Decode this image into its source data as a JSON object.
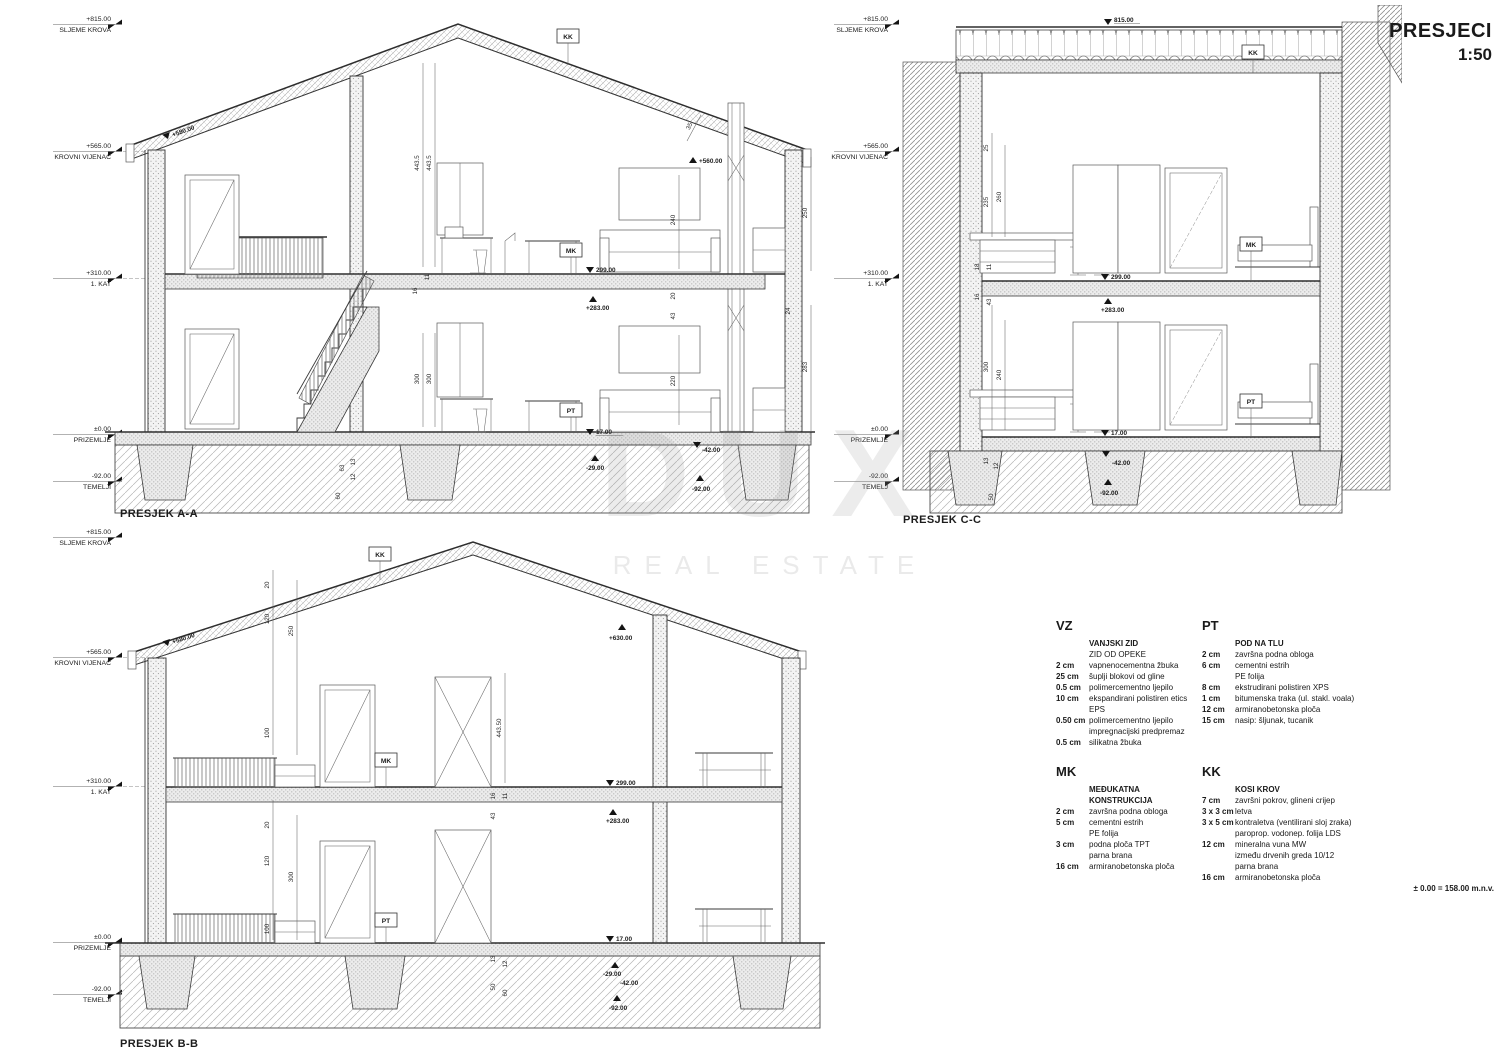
{
  "sheet": {
    "title": "PRESJECI",
    "scale": "1:50",
    "datum_note": "± 0.00 = 158.00 m.n.v."
  },
  "watermark": {
    "line1": "DUX",
    "line2": "REAL ESTATE"
  },
  "sections": {
    "aa": {
      "caption": "PRESJEK A-A",
      "levels": [
        {
          "v": "+815.00",
          "l": "SLJEME KROVA"
        },
        {
          "v": "+565.00",
          "l": "KROVNI VIJENAC"
        },
        {
          "v": "+310.00",
          "l": "1. KAT"
        },
        {
          "v": "±0.00",
          "l": "PRIZEMLJE"
        },
        {
          "v": "-92.00",
          "l": "TEMELJI"
        }
      ],
      "tags": {
        "kk": "KK",
        "mk": "MK",
        "pt": "PT"
      },
      "spots": {
        "roof_l": "+580.00",
        "roof_r": "+560.00",
        "slab_top": "299.00",
        "slab_bot": "+283.00",
        "floor": "17.00",
        "below": "-29.00",
        "footing": "-42.00",
        "base": "-92.00"
      },
      "dims": [
        "443.5",
        "443.5",
        "35",
        "240",
        "250",
        "16",
        "11",
        "20",
        "43",
        "24",
        "300",
        "300",
        "220",
        "283",
        "63",
        "13",
        "12",
        "60"
      ]
    },
    "cc": {
      "caption": "PRESJEK C-C",
      "levels": [
        {
          "v": "+815.00",
          "l": "SLJEME KROVA"
        },
        {
          "v": "+565.00",
          "l": "KROVNI VIJENAC"
        },
        {
          "v": "+310.00",
          "l": "1. KAT"
        },
        {
          "v": "±0.00",
          "l": "PRIZEMLJE"
        },
        {
          "v": "-92.00",
          "l": "TEMELJ"
        }
      ],
      "tags": {
        "kk": "KK",
        "mk": "MK",
        "pt": "PT"
      },
      "spots": {
        "peak": "815.00",
        "slab_top": "299.00",
        "slab_bot": "+283.00",
        "floor": "17.00",
        "footing": "-42.00",
        "base": "-92.00"
      },
      "dims": [
        "25",
        "235",
        "260",
        "18",
        "11",
        "16",
        "43",
        "300",
        "240",
        "13",
        "12",
        "50"
      ]
    },
    "bb": {
      "caption": "PRESJEK B-B",
      "levels": [
        {
          "v": "+815.00",
          "l": "SLJEME KROVA"
        },
        {
          "v": "+565.00",
          "l": "KROVNI VIJENAC"
        },
        {
          "v": "+310.00",
          "l": "1. KAT"
        },
        {
          "v": "±0.00",
          "l": "PRIZEMLJE"
        },
        {
          "v": "-92.00",
          "l": "TEMELJI"
        }
      ],
      "tags": {
        "kk": "KK",
        "mk": "MK",
        "pt": "PT"
      },
      "spots": {
        "eave": "+580.00",
        "top": "+630.00",
        "slab_top": "299.00",
        "slab_bot": "+283.00",
        "floor": "17.00",
        "below": "-29.00",
        "footing": "-42.00",
        "base": "-92.00"
      },
      "dims": [
        "20",
        "120",
        "250",
        "100",
        "443.50",
        "16",
        "43",
        "11",
        "20",
        "120",
        "300",
        "100",
        "13",
        "12",
        "50",
        "60"
      ]
    }
  },
  "legend": {
    "blocks": [
      {
        "code": "VZ",
        "rows": [
          {
            "d": "",
            "t": "VANJSKI ZID"
          },
          {
            "d": "",
            "t": "ZID OD OPEKE"
          },
          {
            "d": "2 cm",
            "t": "vapnenocementna žbuka"
          },
          {
            "d": "25 cm",
            "t": "šuplji blokovi od gline"
          },
          {
            "d": "0.5 cm",
            "t": "polimercementno ljepilo"
          },
          {
            "d": "10 cm",
            "t": "ekspandirani polistiren etics EPS"
          },
          {
            "d": "0.50 cm",
            "t": "polimercementno ljepilo"
          },
          {
            "d": "",
            "t": "impregnacijski predpremaz"
          },
          {
            "d": "0.5 cm",
            "t": "silikatna žbuka"
          }
        ]
      },
      {
        "code": "PT",
        "rows": [
          {
            "d": "",
            "t": "POD NA TLU"
          },
          {
            "d": "2 cm",
            "t": "završna podna obloga"
          },
          {
            "d": "6 cm",
            "t": "cementni estrih"
          },
          {
            "d": "",
            "t": "PE folija"
          },
          {
            "d": "8 cm",
            "t": "ekstrudirani polistiren XPS"
          },
          {
            "d": "1 cm",
            "t": "bitumenska traka (ul. stakl. voala)"
          },
          {
            "d": "12 cm",
            "t": "armiranobetonska ploča"
          },
          {
            "d": "15 cm",
            "t": "nasip: šljunak, tucanik"
          }
        ]
      },
      {
        "code": "MK",
        "rows": [
          {
            "d": "",
            "t": "MEĐUKATNA KONSTRUKCIJA"
          },
          {
            "d": "2 cm",
            "t": "završna podna obloga"
          },
          {
            "d": "5 cm",
            "t": "cementni estrih"
          },
          {
            "d": "",
            "t": "PE folija"
          },
          {
            "d": "3 cm",
            "t": "podna ploča TPT"
          },
          {
            "d": "",
            "t": "parna brana"
          },
          {
            "d": "16 cm",
            "t": "armiranobetonska ploča"
          }
        ]
      },
      {
        "code": "KK",
        "rows": [
          {
            "d": "",
            "t": "KOSI KROV"
          },
          {
            "d": "7 cm",
            "t": "završni pokrov, glineni crijep"
          },
          {
            "d": "3 x 3 cm",
            "t": "letva"
          },
          {
            "d": "3 x 5 cm",
            "t": "kontraletva (ventilirani sloj zraka)"
          },
          {
            "d": "",
            "t": "paroprop. vodonep. folija LDS"
          },
          {
            "d": "12 cm",
            "t": "mineralna vuna MW"
          },
          {
            "d": "",
            "t": "između drvenih greda 10/12"
          },
          {
            "d": "",
            "t": "parna brana"
          },
          {
            "d": "16 cm",
            "t": "armiranobetonska ploča"
          }
        ]
      }
    ]
  }
}
